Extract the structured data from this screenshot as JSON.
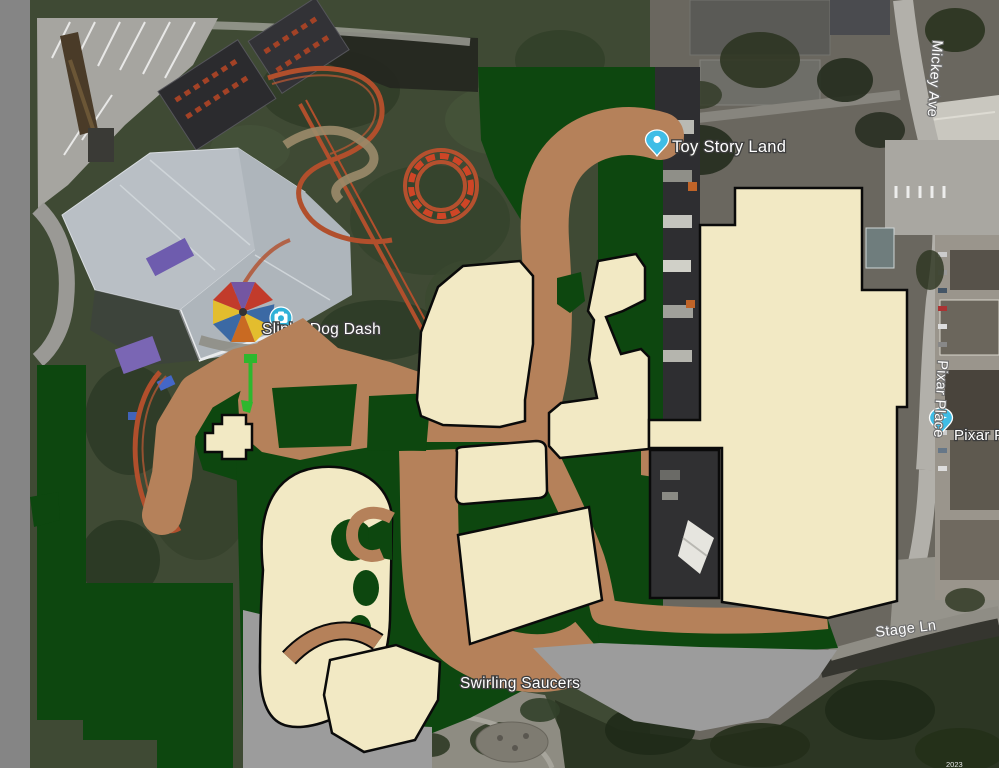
{
  "map": {
    "poi_labels": [
      {
        "text": "Toy Story Land"
      },
      {
        "text": "Slinky Dog Dash"
      },
      {
        "text": "Swirling Saucers"
      },
      {
        "text": "Pixar P"
      }
    ],
    "road_labels": [
      "Mickey Ave",
      "Pixar Place",
      "Stage Ln"
    ],
    "attribution": "2023",
    "pins": [
      {
        "name": "toy-story-land-pin"
      },
      {
        "name": "slinky-dog-dash-photo-pin"
      },
      {
        "name": "pixar-place-pin"
      }
    ],
    "overlay_colors": {
      "path_brown": "#b5815a",
      "vegetation_green": "#0d470f",
      "building_cream": "#f2e9c4",
      "masked_gray": "#9c9c9c",
      "frame_gray": "#858585",
      "annotation_green": "#2eb82e",
      "pin_blue": "#3fbde6"
    }
  }
}
